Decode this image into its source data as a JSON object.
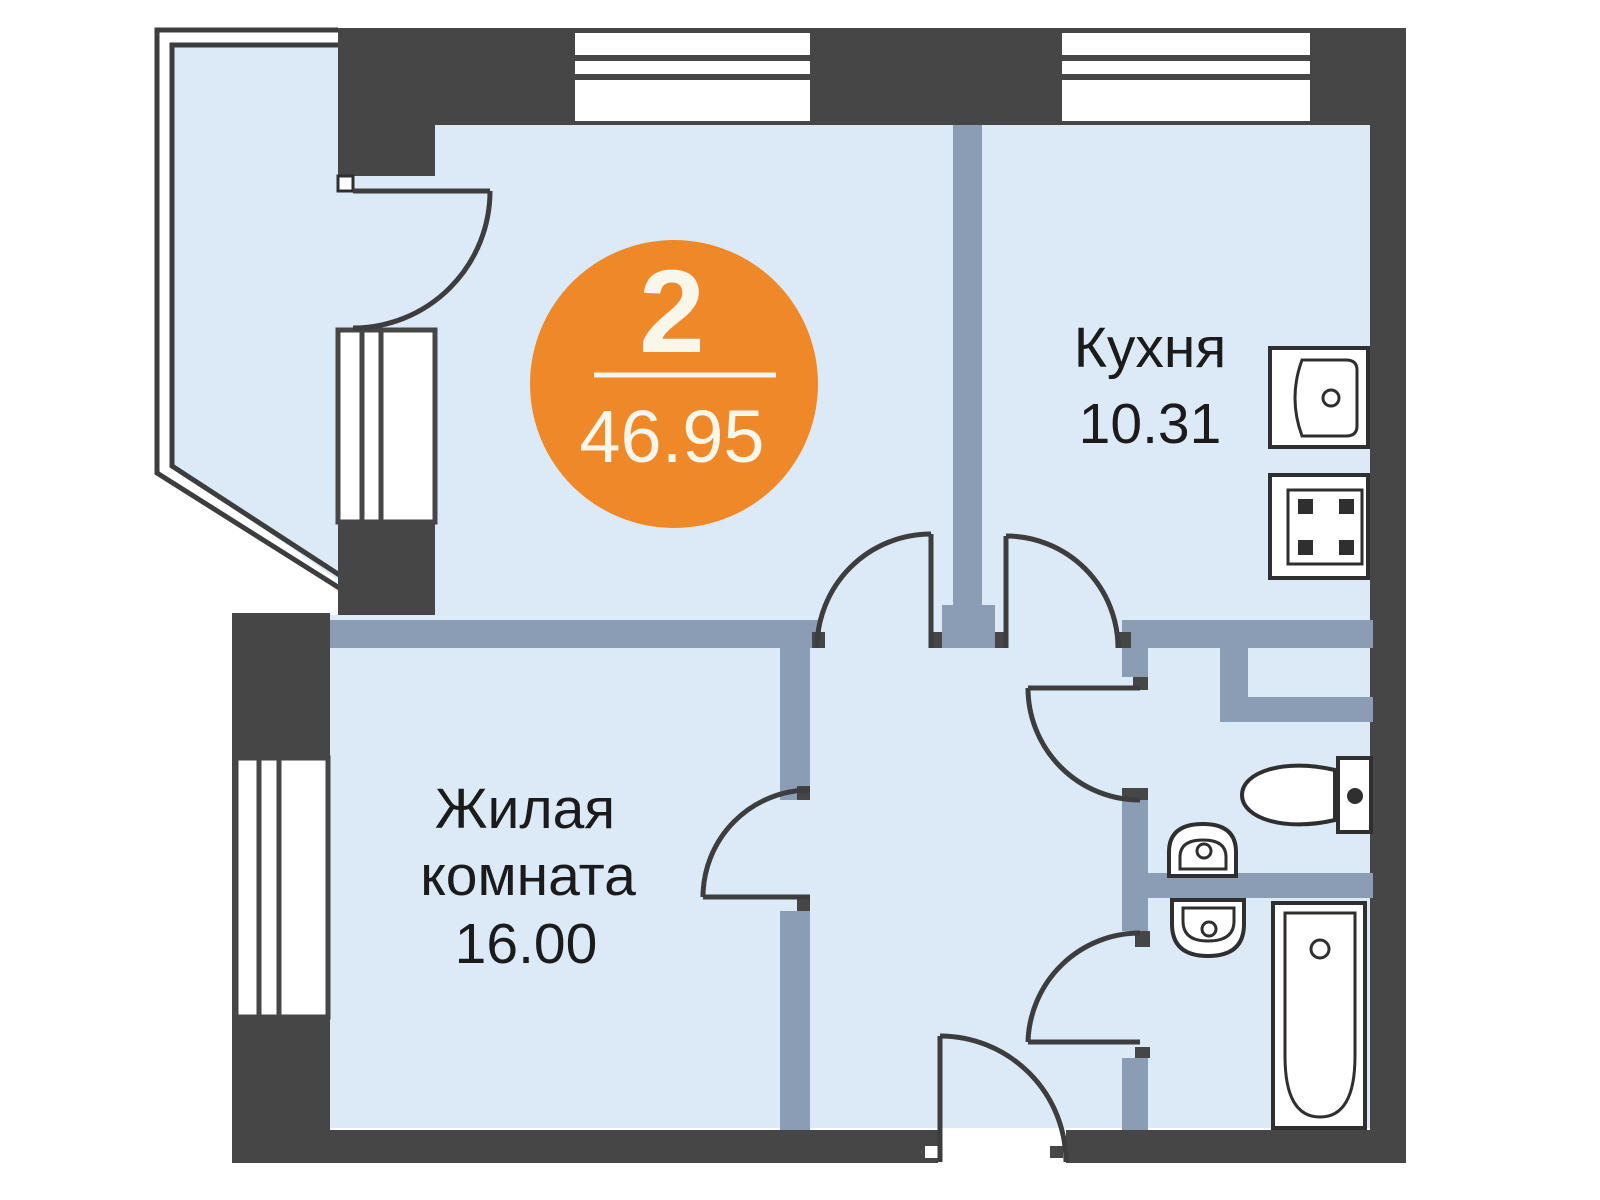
{
  "badge": {
    "rooms_count": "2",
    "total_area": "46.95"
  },
  "rooms": {
    "kitchen": {
      "name": "Кухня",
      "area": "10.31"
    },
    "living": {
      "name_line1": "Жилая",
      "name_line2": "комната",
      "area": "16.00"
    }
  },
  "fixtures": [
    "kitchen-sink",
    "stove",
    "toilet",
    "toilet-tank",
    "washbasin-wc",
    "washbasin-bath",
    "bathtub"
  ],
  "colors": {
    "accent_orange": "#EF8829",
    "wall_dark": "#464646",
    "partition_blue": "#8B9CB5",
    "floor_light_blue": "#DCEAF8",
    "label_text": "#1B1B1B",
    "badge_text": "#FAF6EA"
  }
}
